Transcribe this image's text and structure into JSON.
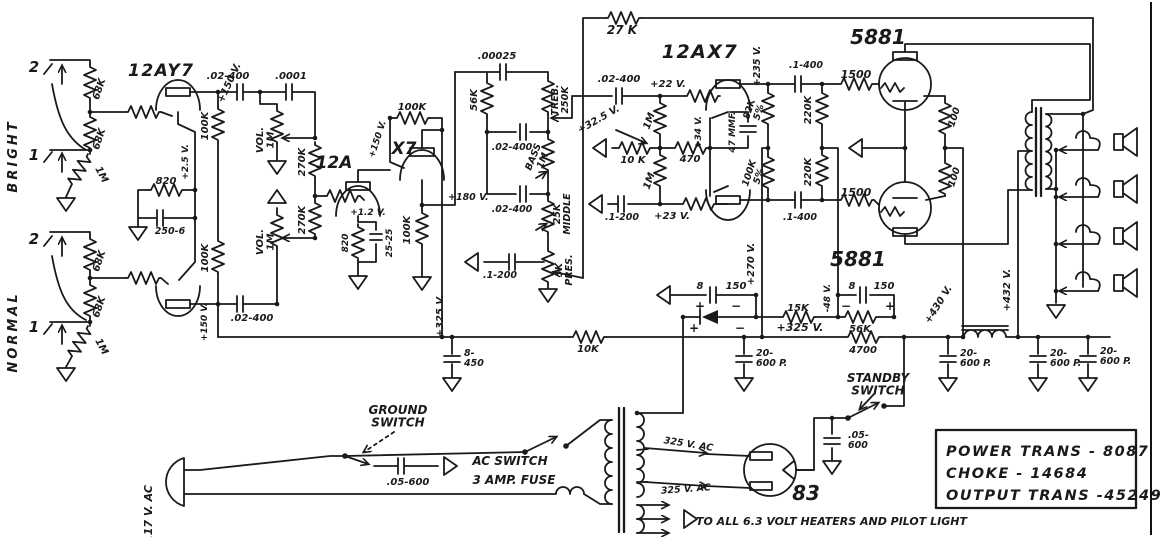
{
  "colors": {
    "ink": "#1a1a1a",
    "paper": "#ffffff"
  },
  "inputs": {
    "bright": "BRIGHT",
    "normal": "NORMAL",
    "bright_jack2": "2",
    "bright_jack1": "1",
    "normal_jack2": "2",
    "normal_jack1": "1",
    "bright_r1": "68K",
    "bright_r2": "68K",
    "bright_rleak": "1M",
    "normal_r1": "68K",
    "normal_r2": "68K",
    "normal_rleak": "1M"
  },
  "preamp": {
    "v1": "12AY7",
    "v1_plate_top_v": "+150 V.",
    "v1_plate_bot_v": "+150 V.",
    "v1_rp_top": "100K",
    "v1_rp_bot": "100K",
    "v1_rk": "820",
    "v1_vk": "+2.5 V.",
    "v1_ck": "250-6",
    "cap_top": ".02-400",
    "cap_bright": ".0001",
    "cap_bot": ".02-400",
    "vol_top": "VOL.\n1M",
    "vol_bot": "VOL.\n1M",
    "rmix_top": "270K",
    "rmix_bot": "270K",
    "v2a": "12A",
    "v2b": "X7",
    "v2_plate_v": "+150 V.",
    "v2_rp": "100K",
    "v2_rk": "820",
    "v2_ck": "25-25",
    "v2_vk": "+1.2 V.",
    "cf_rk": "100K",
    "cf_vk": "+180 V."
  },
  "tone": {
    "c_treble": ".00025",
    "r_slope": "56K",
    "treble": "TREB.\n250K",
    "c1": ".02-400",
    "bass": "BASS\n1M",
    "middle": "25K\nMIDDLE",
    "c2": ".02-400",
    "presence": "5K\nPRES.",
    "c_pres": ".1-200"
  },
  "pi": {
    "nfb_r": "27 K",
    "c_in": ".02-400",
    "v_in": "+22 V.",
    "r_grid1": "1M",
    "r_grid2": "1M",
    "v_tail": "+32.5 V.",
    "r_tail": "10 K",
    "r_cath": "470",
    "v_cath": "+34 V.",
    "c_boot": "47 MMF.",
    "c_grid2": ".1-200",
    "v_grid2": "+23 V.",
    "tube": "12AX7",
    "v_plate": "+235 V.",
    "r_plate1": "82K\n5%",
    "r_plate2": "100K\n5%",
    "c_out1": ".1-400",
    "c_out2": ".1-400",
    "r_g1": "220K",
    "r_g2": "220K"
  },
  "output": {
    "tube1": "5881",
    "tube2": "5881",
    "r_stop1": "1500",
    "r_stop2": "1500",
    "r_screen1": "100",
    "r_screen2": "100",
    "v_screen": "+430 V.",
    "v_plate": "+432 V."
  },
  "supply": {
    "c_pre": "8-\n450",
    "v_node1": "+325 V.",
    "r_drop": "10K",
    "v_node2": "+325 V.",
    "v_preamp": "+270 V.",
    "r_4700": "4700",
    "bias_c1": "8",
    "bias_c1b": "150",
    "bias_c2": "8",
    "bias_c2b": "150",
    "bias_r1": "15K",
    "bias_r2": "56K",
    "bias_v": "-48 V.",
    "p1": "+",
    "m1": "−",
    "p2": "+",
    "m2": "−",
    "p3": "+",
    "m3": "−",
    "c_main1": "20-\n600 P.",
    "c_main2": "20-\n600 P.",
    "c_main3": "20-\n600 P.",
    "c_main4": "20-\n600 P.",
    "standby": "STANDBY\nSWITCH",
    "c_standby": ".05-\n600"
  },
  "mains": {
    "voltage": "117 V. AC",
    "ground_switch": "GROUND\nSWITCH",
    "c_ground": ".05-600",
    "ac_switch": "AC SWITCH",
    "fuse": "3 AMP. FUSE",
    "hv1": "325 V. AC",
    "hv2": "325 V. AC",
    "rectifier": "83",
    "heaters": "TO ALL 6.3 VOLT HEATERS AND PILOT LIGHT"
  },
  "parts_box": {
    "line1": "POWER TRANS - 8087",
    "line2": "CHOKE   -   14684",
    "line3": "OUTPUT TRANS -45249"
  }
}
